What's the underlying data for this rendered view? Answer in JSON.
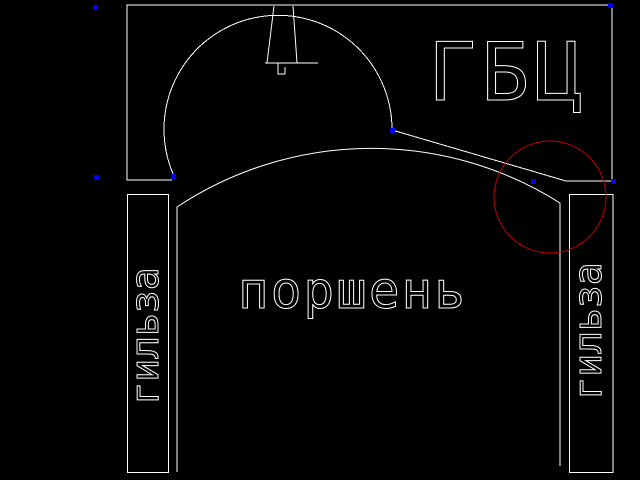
{
  "drawing": {
    "labels": {
      "cylinder_head": "ГБЦ",
      "piston": "поршень",
      "liner_left": "гильза",
      "liner_right": "гильза"
    },
    "colors": {
      "background": "#000000",
      "line": "#ffffff",
      "highlight": "#c00000",
      "grip": "#0000ff"
    },
    "grips": [
      {
        "x": 95,
        "y": 7
      },
      {
        "x": 96,
        "y": 177
      },
      {
        "x": 173,
        "y": 176
      },
      {
        "x": 392,
        "y": 130
      },
      {
        "x": 533,
        "y": 181
      },
      {
        "x": 610,
        "y": 5
      },
      {
        "x": 613,
        "y": 181
      }
    ]
  }
}
